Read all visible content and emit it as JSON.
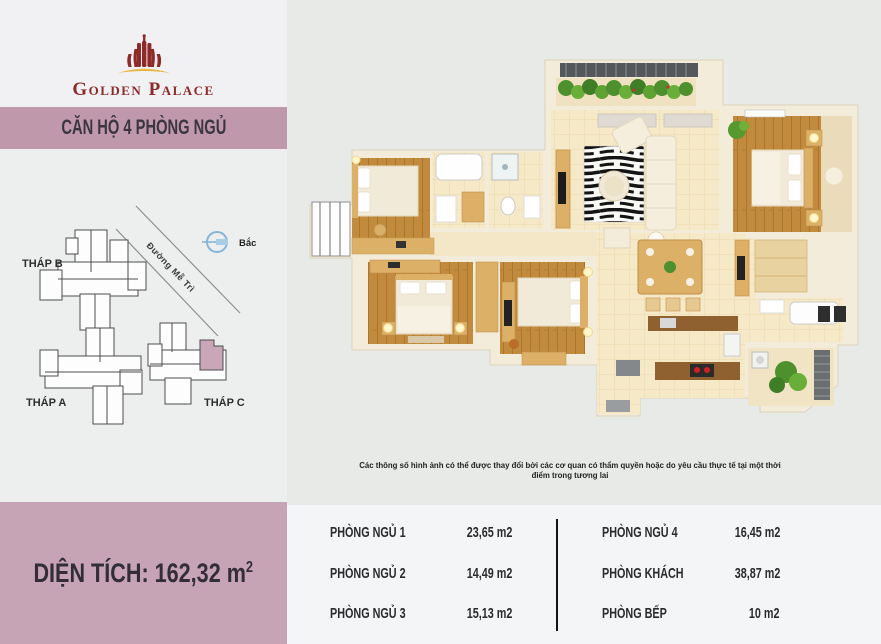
{
  "header": {
    "brand": "Golden Palace",
    "logo_icon": "golden-palace-tower-icon"
  },
  "banner": {
    "title": "CĂN HỘ 4 PHÒNG NGỦ"
  },
  "site_map": {
    "towers": [
      {
        "label": "THÁP B"
      },
      {
        "label": "THÁP A"
      },
      {
        "label": "THÁP C"
      }
    ],
    "street_label": "Đường Mễ Trì",
    "compass_label": "Bắc",
    "highlight_color": "#c9a6b8"
  },
  "floor_plan": {
    "disclaimer": "Các thông số hình ảnh có thể được thay đổi bởi các cơ quan có thẩm quyền hoặc do yêu cầu thực tế tại một thời điểm trong tương lai"
  },
  "area_box": {
    "text": "DIỆN TÍCH: 162,32 m",
    "sup": "2",
    "value": "162,32",
    "unit": "m2"
  },
  "rooms": {
    "left": [
      {
        "name": "PHÒNG NGỦ 1",
        "area": "23,65 m2"
      },
      {
        "name": "PHÒNG NGỦ 2",
        "area": "14,49 m2"
      },
      {
        "name": "PHÒNG NGỦ 3",
        "area": "15,13 m2"
      }
    ],
    "right": [
      {
        "name": "PHÒNG NGỦ 4",
        "area": "16,45 m2"
      },
      {
        "name": "PHÒNG KHÁCH",
        "area": "38,87 m2"
      },
      {
        "name": "PHÒNG BẾP",
        "area": "10 m2"
      }
    ]
  },
  "colors": {
    "brand_red": "#8e2a28",
    "brand_gold": "#e9b642",
    "banner_mauve": "#bf98ab",
    "area_box_mauve": "#c6a3b5",
    "compass_blue": "#85b4d8"
  }
}
